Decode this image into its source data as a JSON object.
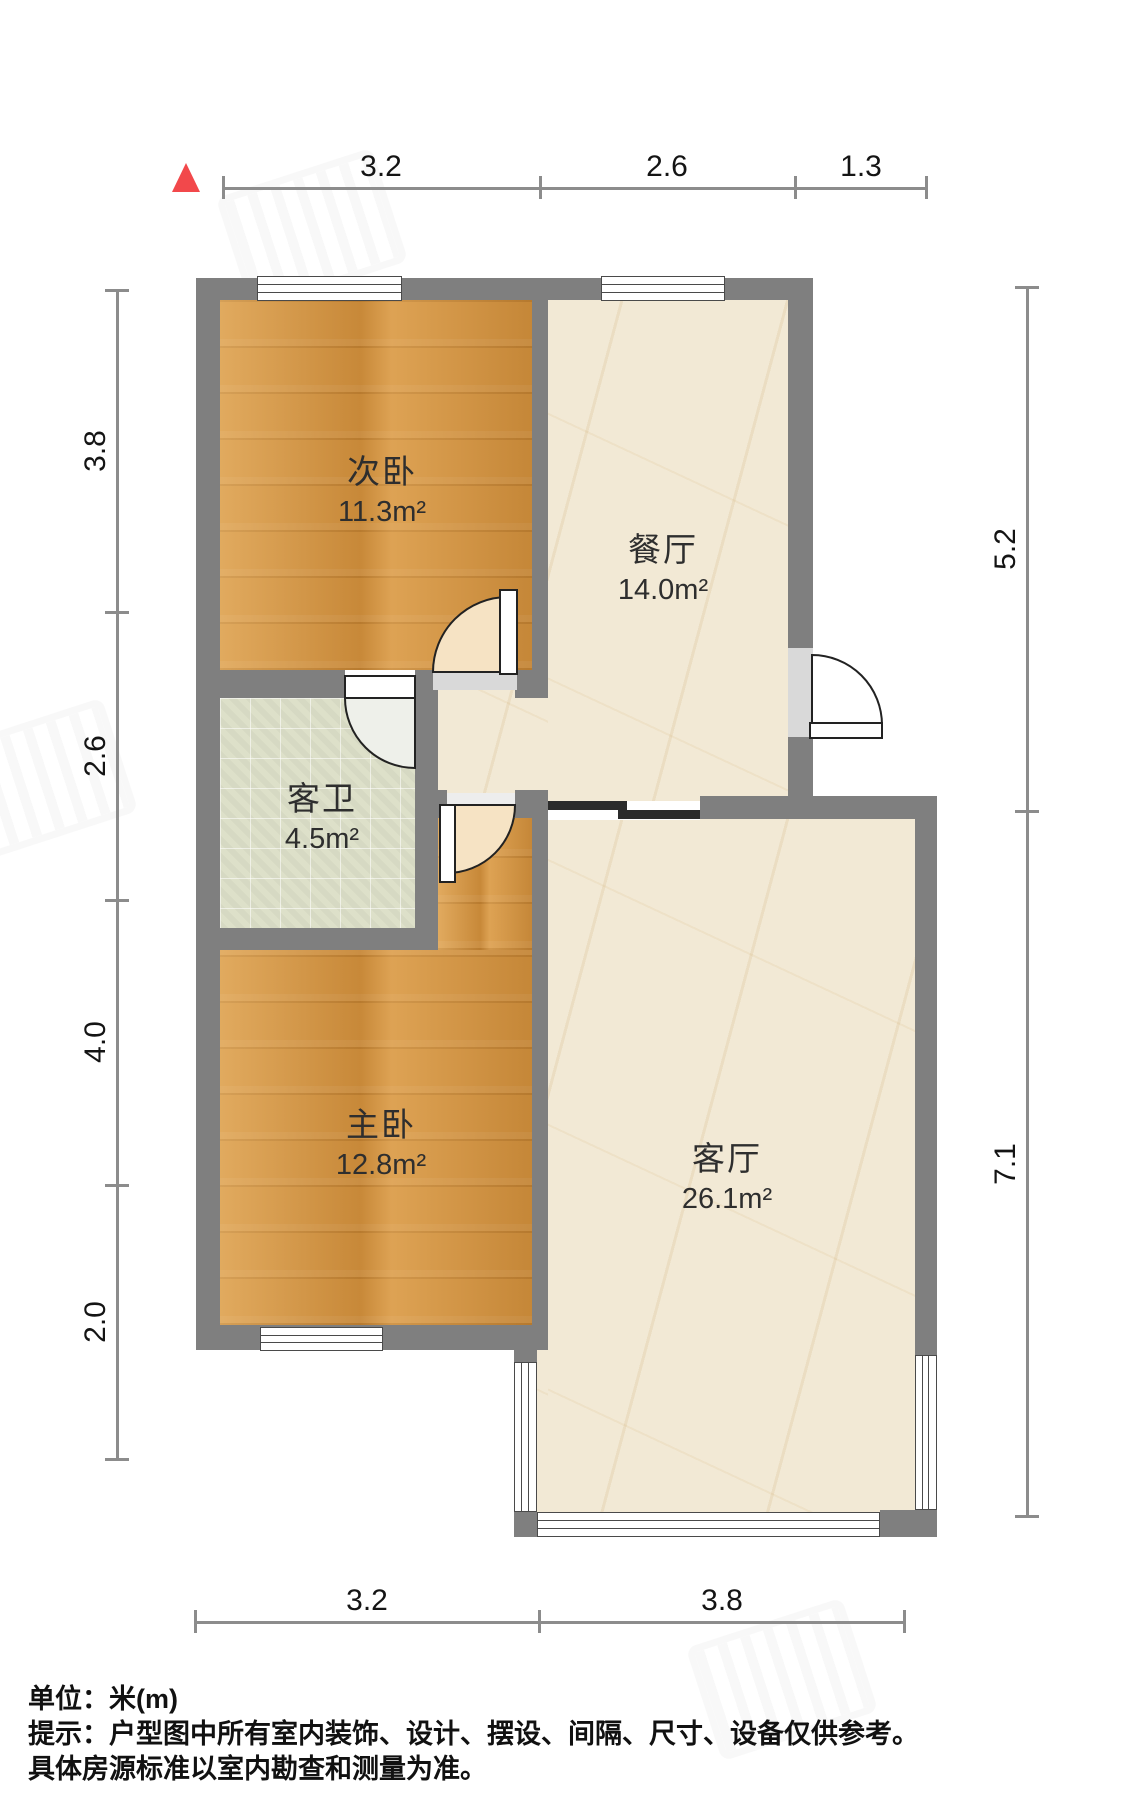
{
  "plan": {
    "title": "户型图",
    "unit_scale": "米",
    "north_arrow": {
      "icon": "north-triangle-icon",
      "color": "#f2484b"
    },
    "colors": {
      "wall": "#7f7f7f",
      "thin_wall": "#2b2b2b",
      "wood_floor": "#d4913c",
      "marble_floor": "#f2e9d5",
      "tile_floor": "#dde0c9",
      "north_arrow": "#f2484b",
      "dimension_line": "#8c8c8c"
    }
  },
  "rooms": [
    {
      "name": "次卧",
      "area": "11.3m²"
    },
    {
      "name": "餐厅",
      "area": "14.0m²"
    },
    {
      "name": "客卫",
      "area": "4.5m²"
    },
    {
      "name": "主卧",
      "area": "12.8m²"
    },
    {
      "name": "客厅",
      "area": "26.1m²"
    }
  ],
  "dimensions": {
    "top": [
      "3.2",
      "2.6",
      "1.3"
    ],
    "left": [
      "3.8",
      "2.6",
      "4.0",
      "2.0"
    ],
    "right": [
      "5.2",
      "7.1"
    ],
    "bottom": [
      "3.2",
      "3.8"
    ]
  },
  "footer": {
    "unit_label": "单位：米(m)",
    "note_line1": "提示：户型图中所有室内装饰、设计、摆设、间隔、尺寸、设备仅供参考。",
    "note_line2": "具体房源标准以室内勘查和测量为准。"
  }
}
